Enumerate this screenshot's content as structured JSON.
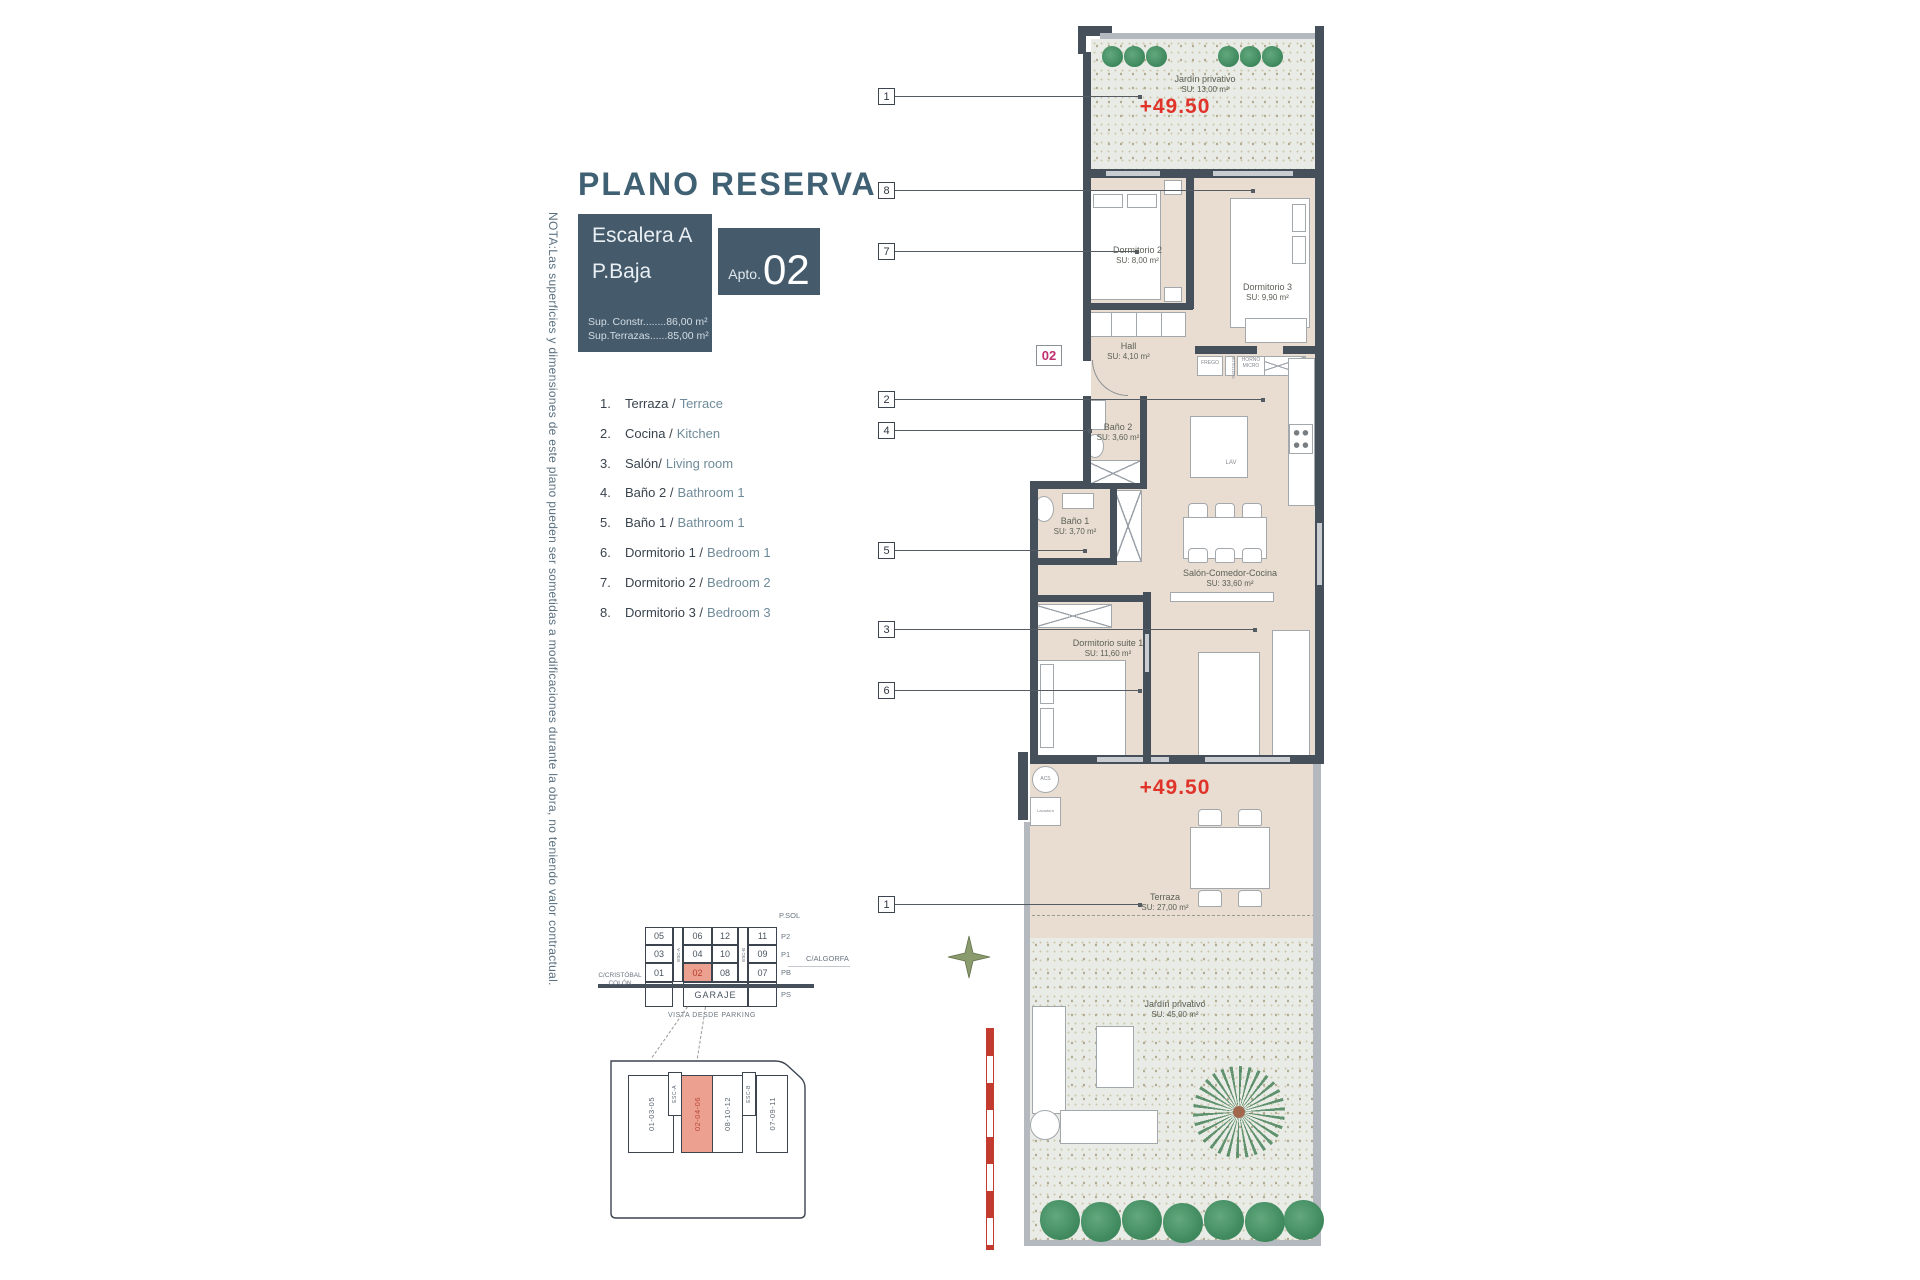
{
  "title": "PLANO RESERVA",
  "note": "NOTA:Las superficies y dimensiones de este plano pueden ser sometidas a modificaciones durante la obra, no teniendo valor contractual.",
  "header": {
    "stair": "Escalera A",
    "floor": "P.Baja",
    "apto_label": "Apto.",
    "apto_number": "02",
    "sup_constr": "Sup. Constr........86,00 m²",
    "sup_terrazas": "Sup.Terrazas......85,00 m²"
  },
  "legend": [
    {
      "num": "1.",
      "es": "Terraza /",
      "en": "Terrace"
    },
    {
      "num": "2.",
      "es": "Cocina /",
      "en": "Kitchen"
    },
    {
      "num": "3.",
      "es": "Salón/",
      "en": "Living room"
    },
    {
      "num": "4.",
      "es": "Baño 2 /",
      "en": "Bathroom 1"
    },
    {
      "num": "5.",
      "es": "Baño 1 /",
      "en": "Bathroom 1"
    },
    {
      "num": "6.",
      "es": "Dormitorio 1 /",
      "en": "Bedroom 1"
    },
    {
      "num": "7.",
      "es": "Dormitorio 2 /",
      "en": "Bedroom 2"
    },
    {
      "num": "8.",
      "es": "Dormitorio 3 /",
      "en": "Bedroom 3"
    }
  ],
  "plan": {
    "unit_tag": "02",
    "elevation_top": "+49.50",
    "elevation_terrace": "+49.50",
    "callouts": [
      "1",
      "8",
      "7",
      "2",
      "4",
      "5",
      "3",
      "6",
      "1"
    ],
    "rooms": {
      "jardin_top": {
        "name": "Jardín privativo",
        "su": "SU: 13,00 m²"
      },
      "dorm2": {
        "name": "Dormitorio 2",
        "su": "SU: 8,00 m²"
      },
      "dorm3": {
        "name": "Dormitorio 3",
        "su": "SU: 9,90 m²"
      },
      "hall": {
        "name": "Hall",
        "su": "SU: 4,10 m²"
      },
      "bano2": {
        "name": "Baño 2",
        "su": "SU: 3,60 m²"
      },
      "bano1": {
        "name": "Baño 1",
        "su": "SU: 3,70 m²"
      },
      "salon": {
        "name": "Salón-Comedor-Cocina",
        "su": "SU: 33,60 m²"
      },
      "suite": {
        "name": "Dormitorio suite 1",
        "su": "SU: 11,60 m²"
      },
      "terraza": {
        "name": "Terraza",
        "su": "SU: 27,00 m²"
      },
      "jardin_bottom": {
        "name": "Jardín privativo",
        "su": "SU: 45,00 m²"
      }
    },
    "fixtures": {
      "frego": "FREGO",
      "botellero": "BOTELLERO",
      "horno_micro": "HORNO MICRO",
      "lav": "LAV",
      "acs": "ACS",
      "lavadora": "Lavadora"
    }
  },
  "garage_key": {
    "roof_label": "P.SOL",
    "rows": [
      {
        "cells": [
          "05",
          "06",
          "12",
          "11"
        ],
        "label": "P2"
      },
      {
        "cells": [
          "03",
          "04",
          "10",
          "09"
        ],
        "label": "P1"
      },
      {
        "cells": [
          "01",
          "02",
          "08",
          "07"
        ],
        "label": "PB"
      }
    ],
    "garaje": "GARAJE",
    "garaje_label": "PS",
    "esc_a": "ESC-A",
    "esc_b": "ESC-B",
    "street_left": "C/CRISTÓBAL COLÓN",
    "street_right": "C/ALGORFA",
    "caption": "VISTA DESDE PARKING",
    "highlighted_cell": "02"
  },
  "site_key": {
    "strips": [
      "01-03-05",
      "02-04-06",
      "08-10-12",
      "07-09-11"
    ],
    "esc_a": "ESC-A",
    "esc_b": "ESC-B",
    "highlighted_strip": "02-04-06"
  },
  "colors": {
    "slate": "#46505b",
    "title_teal": "#3f6173",
    "legend_en": "#6f8b99",
    "red": "#e0342b",
    "magenta": "#bf2e6e",
    "highlight": "#eca08f",
    "room_beige": "#e9ddd1"
  }
}
